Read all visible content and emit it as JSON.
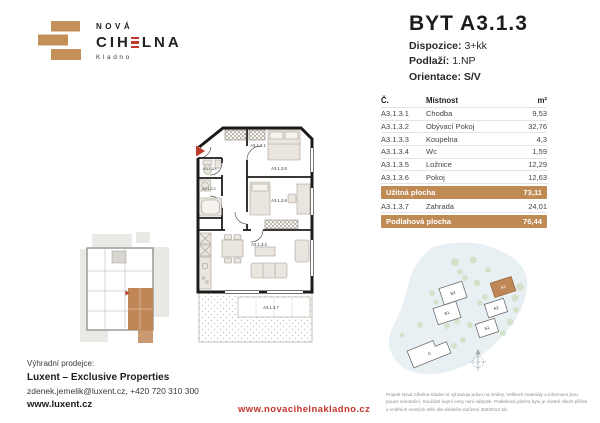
{
  "colors": {
    "brick": "#c3905a",
    "accent_red": "#c0392b",
    "highlight": "#bf8a54"
  },
  "logo": {
    "line1": "NOVÁ",
    "name_pre": "CIH",
    "name_post": "LNA",
    "city": "Kladno"
  },
  "header": {
    "title": "BYT A3.1.3",
    "spec1_label": "Dispozice:",
    "spec1_value": "3+kk",
    "spec2_label": "Podlaží:",
    "spec2_value": "1.NP",
    "spec3_label": "Orientace:",
    "spec3_value": "S/V"
  },
  "table": {
    "col_no": "Č.",
    "col_room": "Místnost",
    "col_area": "m²",
    "rooms": [
      {
        "no": "A3.1.3.1",
        "name": "Chodba",
        "area": "9,53"
      },
      {
        "no": "A3.1.3.2",
        "name": "Obývací Pokoj",
        "area": "32,76"
      },
      {
        "no": "A3.1.3.3",
        "name": "Koupelna",
        "area": "4,3"
      },
      {
        "no": "A3.1.3.4",
        "name": "Wc",
        "area": "1,59"
      },
      {
        "no": "A3.1.3.5",
        "name": "Ložnice",
        "area": "12,29"
      },
      {
        "no": "A3.1.3.6",
        "name": "Pokoj",
        "area": "12,63"
      }
    ],
    "usable_label": "Užitná plocha",
    "usable_area": "73,11",
    "garden_no": "A3.1.3.7",
    "garden_name": "Zahrada",
    "garden_area": "24,01",
    "total_label": "Podlahová plocha",
    "total_area": "76,44"
  },
  "floorplan": {
    "labels": {
      "hall": "A3.1.3.1",
      "living": "A3.1.3.2",
      "bath": "A3.1.3.3",
      "wc": "A3.1.3.4",
      "bedroom": "A3.1.3.5",
      "room": "A3.1.3.6",
      "garden": "A3.1.3.7"
    }
  },
  "siteplan": {
    "b2": "B2",
    "b1": "B1",
    "a3": "A3",
    "a2": "A2",
    "a1": "A1",
    "c": "C"
  },
  "contact": {
    "intro": "Výhradní prodejce:",
    "company": "Luxent – Exclusive Properties",
    "details": "zdenek.jemelik@luxent.cz, +420 720 310 300",
    "web": "www.luxent.cz"
  },
  "footer": {
    "link": "www.novacihelnakladno.cz",
    "disclaimer": "Projekt Nová Cihelna Kladno si vyhrazuje právo na změny. Veškeré materiály a informace jsou pouze orientační. Součástí kupní ceny není nábytek. Podlahová plocha bytu je včetně všech příček a vnitřních nosných stěn dle vládního nařízení 366/2013 Sb."
  }
}
